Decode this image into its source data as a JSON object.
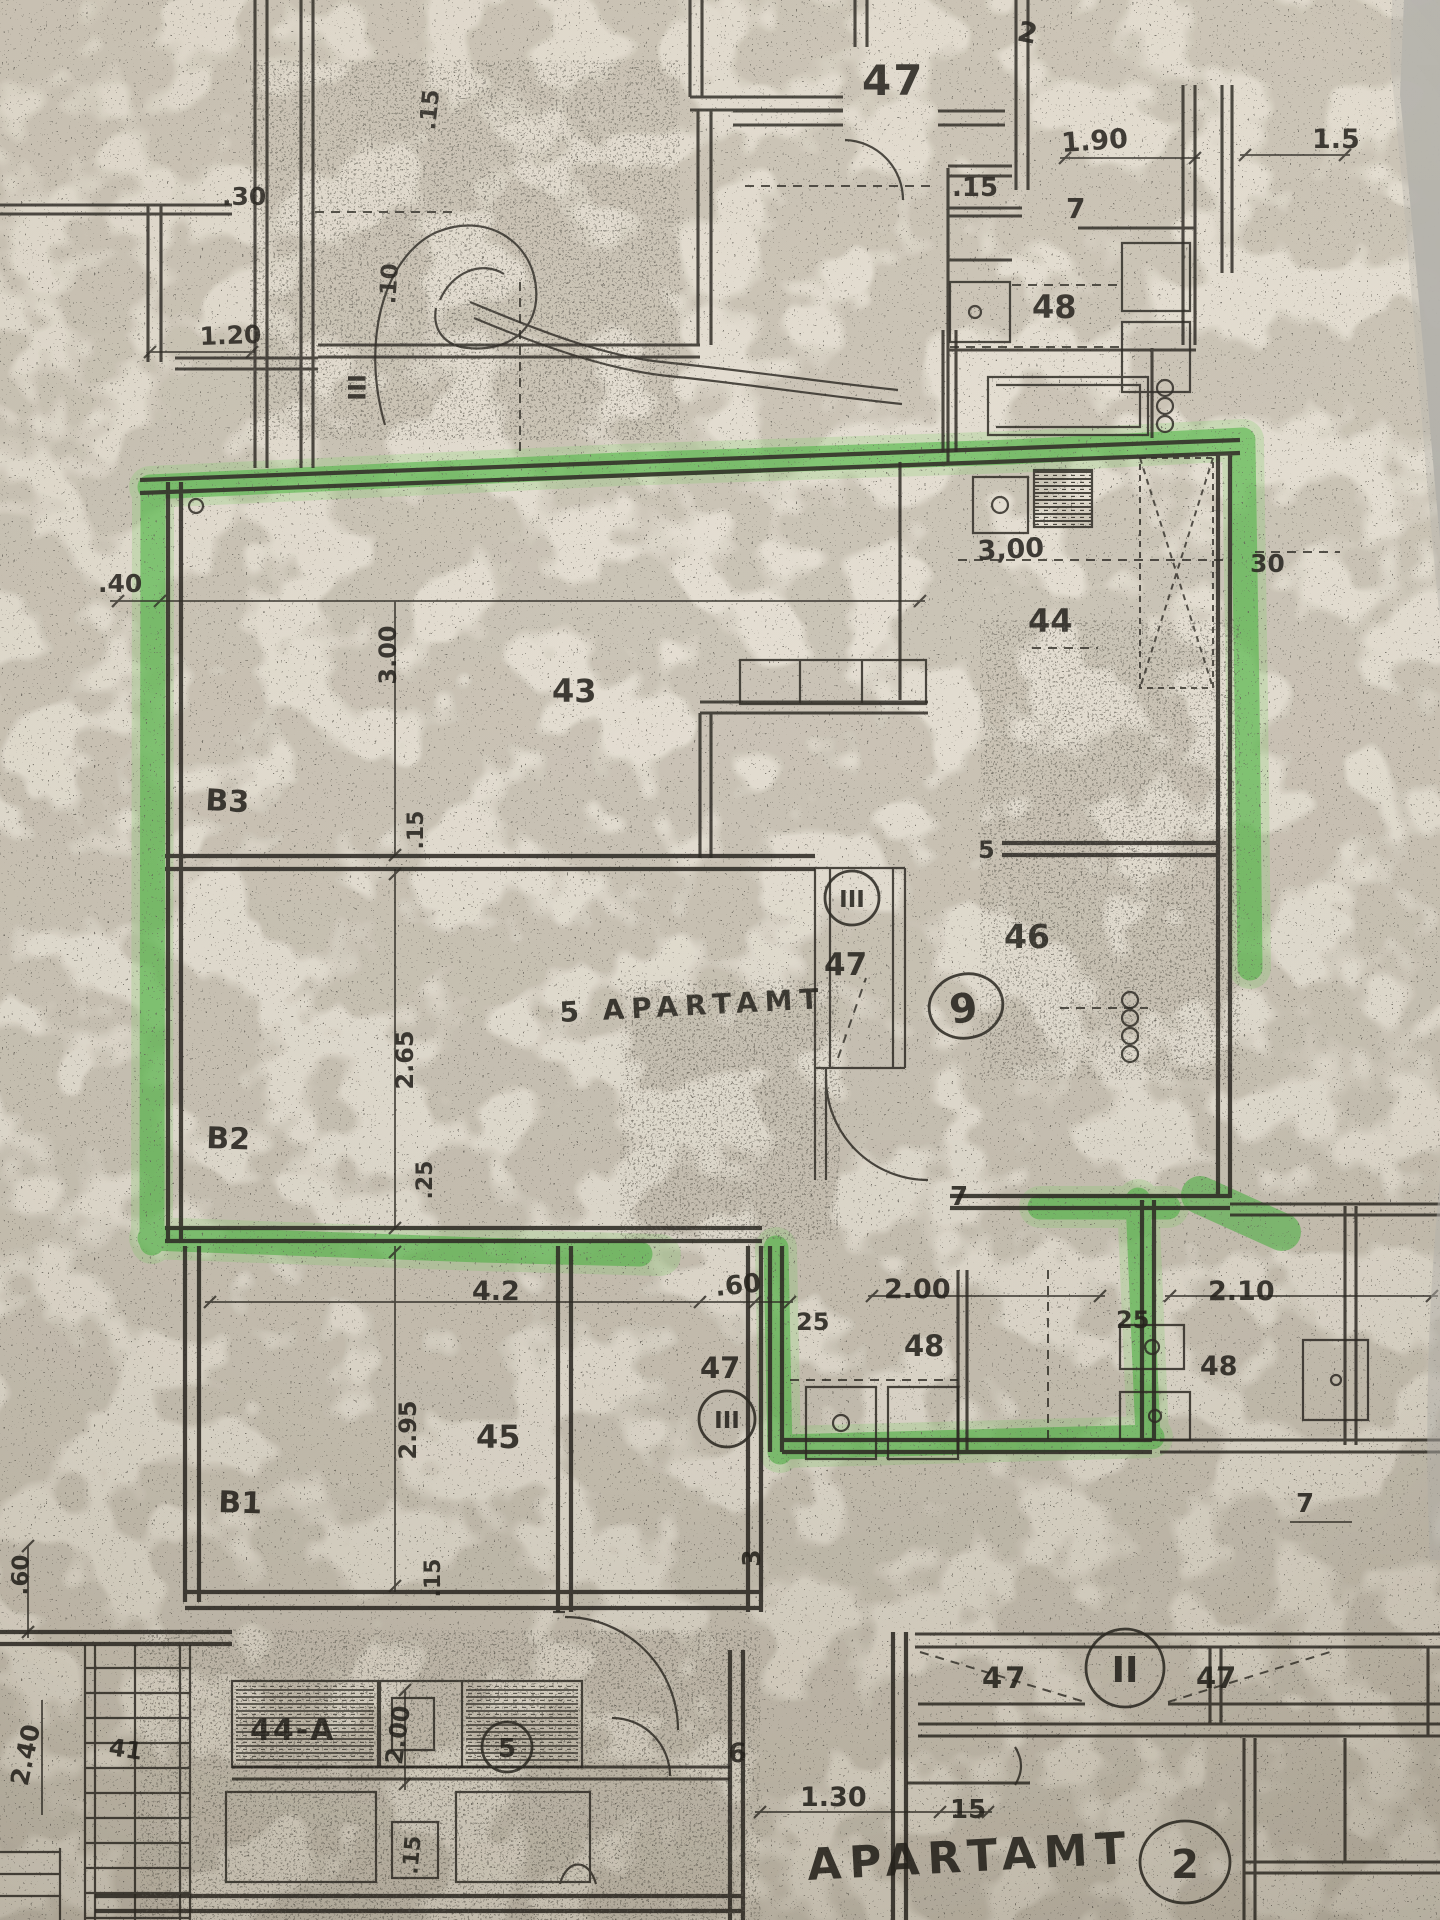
{
  "colors": {
    "paper": "#e8e2d6",
    "ink": "#2b2822",
    "marker_green": "#4eb945",
    "photo_edge_gray": "#b3b1ab"
  },
  "labels": {
    "rooms": {
      "r47_top": "47",
      "r44": "44",
      "r43": "43",
      "r46": "46",
      "r45": "45",
      "r48_top": "48",
      "r48_mid": "48",
      "r48_right": "48",
      "r47_shaft": "47",
      "r47_corr": "47",
      "r47_hall_left": "47",
      "r47_hall_right": "47",
      "r44a": "44-A"
    },
    "zones": {
      "b3": "B3",
      "b2": "B2",
      "b1": "B1"
    },
    "marks": {
      "apt9": "9",
      "apt5_text": "5 APARTAMT",
      "apart_bottom": "APARTAMT",
      "circle2": "2",
      "circle5": "5",
      "hall_ii": "II",
      "shaft_iii": "III",
      "corr_iii": "III",
      "stamp_iii": "III",
      "top2": "2",
      "note41": "41"
    },
    "dims": {
      "d190": "1.90",
      "d15r": "1.5",
      "d15top": ".15",
      "d7top": "7",
      "d30l": ".30",
      "d15v_top": ".15",
      "d10v": ".10",
      "d120": "1.20",
      "d300k": "3,00",
      "d30r": "30",
      "d300v": "3.00",
      "d40": ".40",
      "d15v_mid": ".15",
      "d5door": "5",
      "d265": "2.65",
      "d25v": ".25",
      "d7mid": "7",
      "d42": "4.2",
      "d60": ".60",
      "d25a": "25",
      "d200": "2.00",
      "d210": "2.10",
      "d25b": "25",
      "d295": "2.95",
      "d60v": ".60",
      "d15v_low": ".15",
      "d3v": "3",
      "d240": "2.40",
      "d200v": "2.00",
      "d6": "6",
      "d15v_bot": ".15",
      "d7r": "7",
      "d130": "1.30",
      "d15b": "15"
    }
  }
}
